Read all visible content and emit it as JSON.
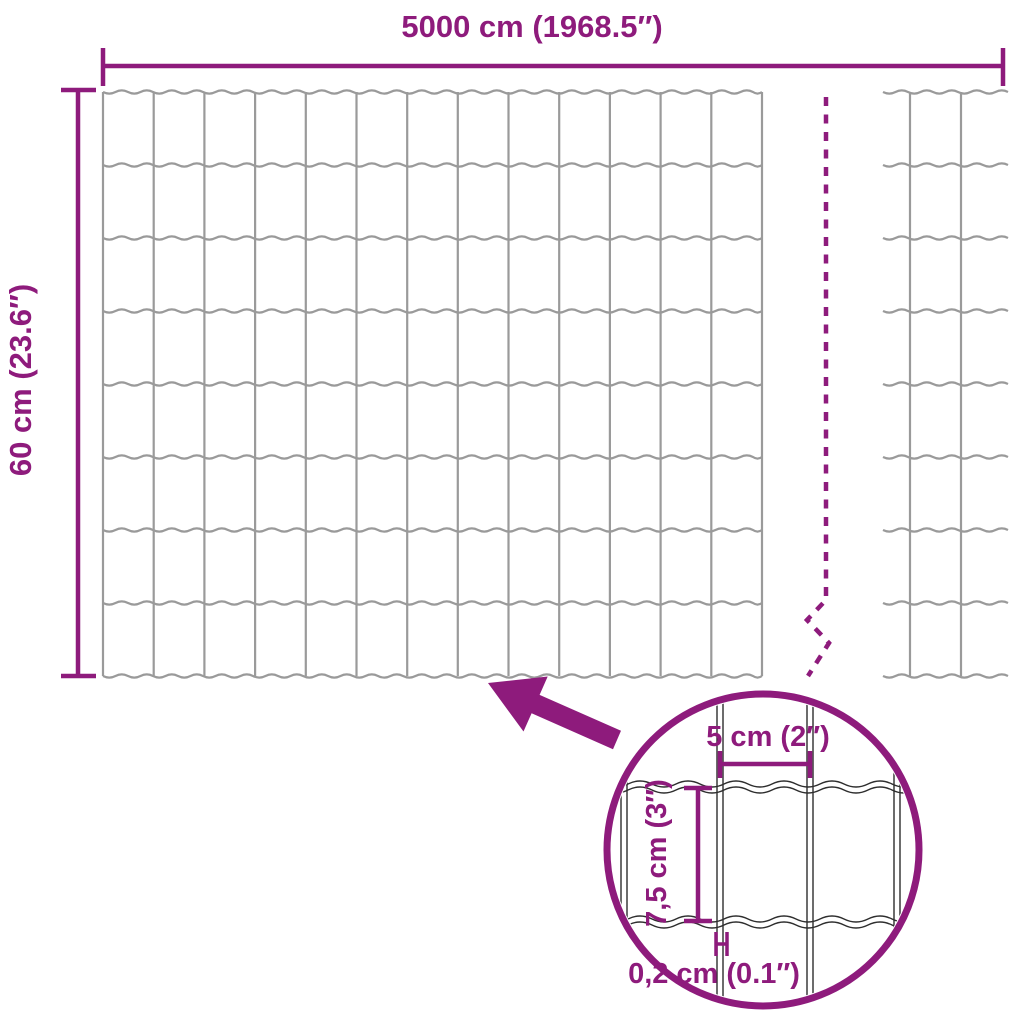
{
  "diagram": {
    "overall_width_label": "5000 cm (1968.5″)",
    "overall_height_label": "60 cm (23.6″)",
    "detail": {
      "cell_width_label": "5 cm (2″)",
      "cell_height_label": "7,5 cm (3″)",
      "wire_diameter_label": "0,2 cm (0.1″)"
    },
    "colors": {
      "accent": "#8E1B7C",
      "mesh_wire": "#9A9A9A",
      "detail_wire": "#2E2E2E",
      "background": "#FFFFFF"
    }
  }
}
